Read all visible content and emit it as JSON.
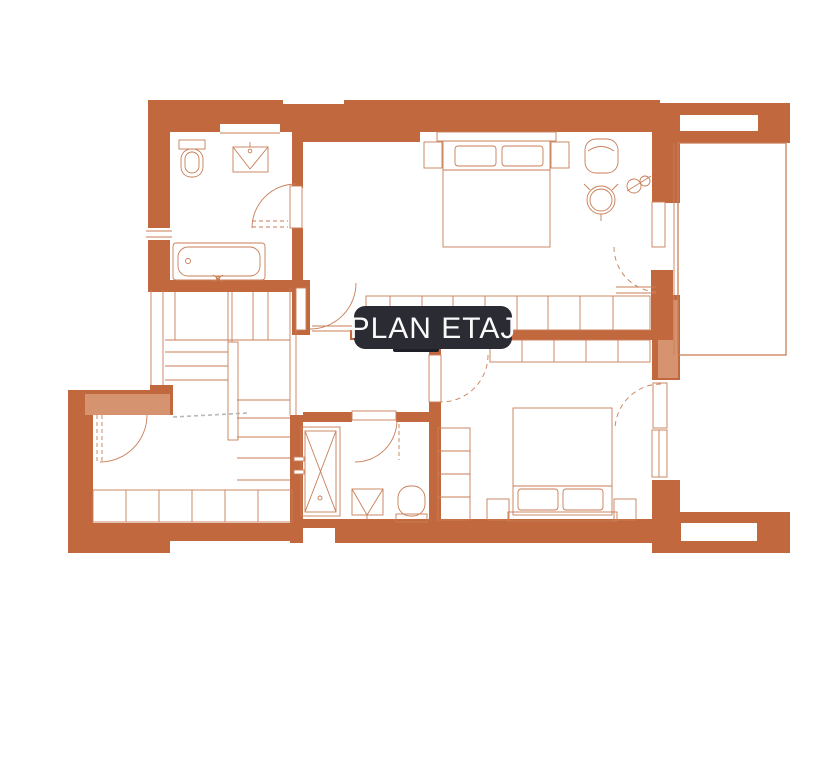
{
  "badge": {
    "label": "PLAN ETAJ"
  },
  "colors": {
    "wall": "#C2683F",
    "wall_light": "#D6936F",
    "line": "#C97E57",
    "cut_line": "#B4B8B8",
    "badge_bg": "#2B2B33",
    "badge_bg_dark": "#1F1F27",
    "badge_text": "#FAFAFA",
    "page_bg": "#FFFFFF"
  }
}
